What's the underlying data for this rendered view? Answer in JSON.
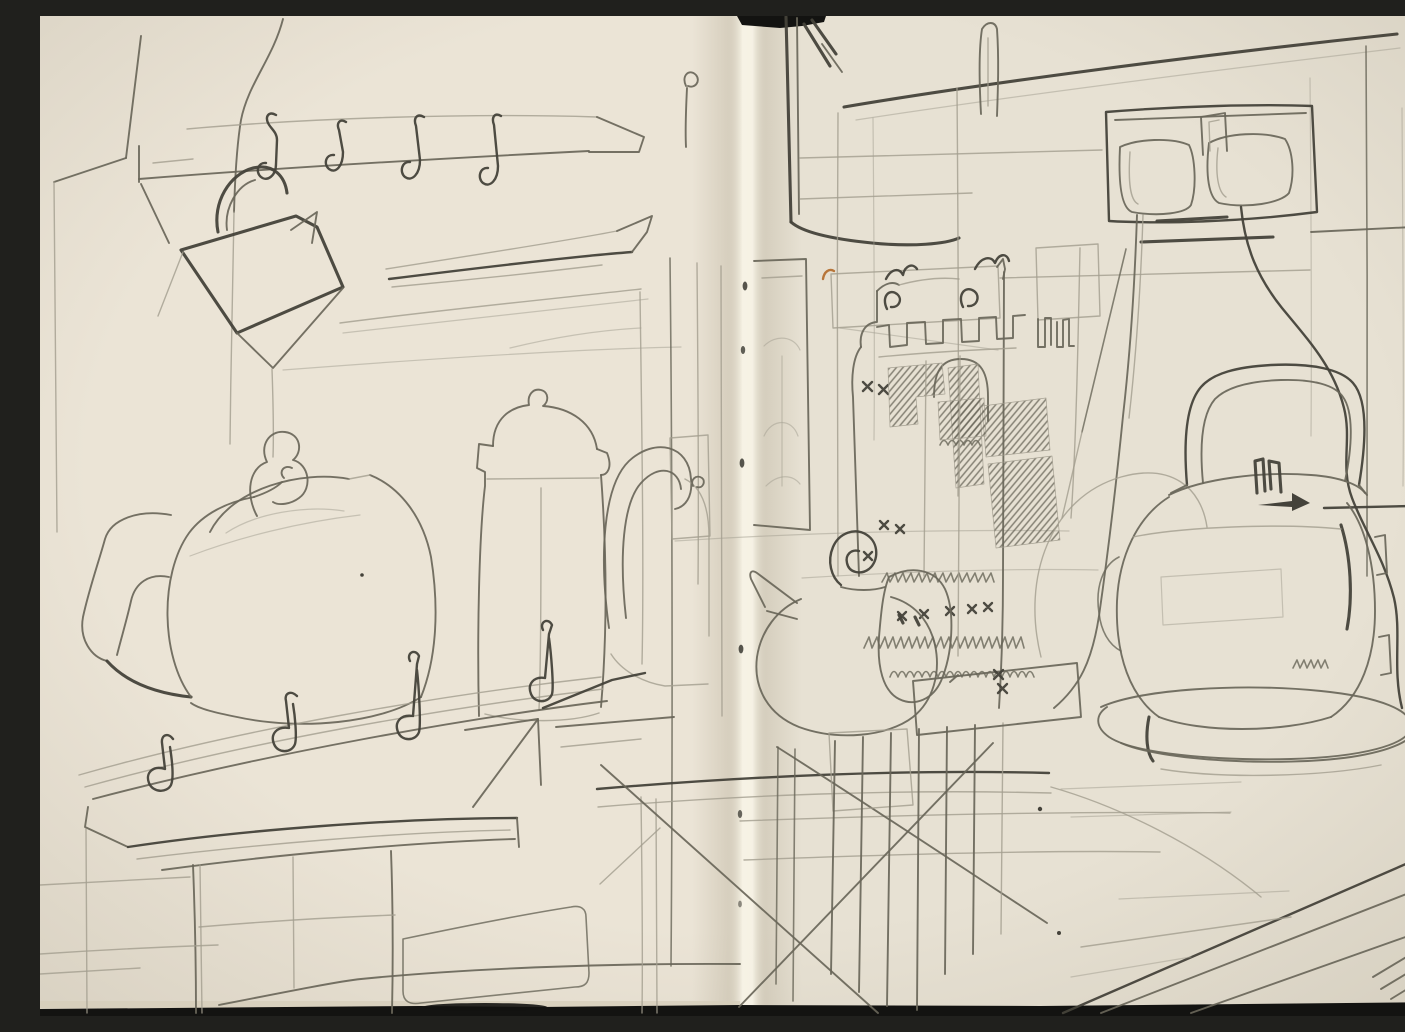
{
  "artwork": {
    "kind": "graphite pencil sketch across a stitched sketchbook double-page spread",
    "subject": "kitchen counter still life",
    "aria_label": "Pencil sketch of a kitchen: on the left page a hook rail with S-hooks and a hanging kettle above a large teapot, tall coffee pot and loop-handled jug on a counter; on the right page a castellated knitted cosy tower, a spiral-lid teapot, a double wall socket with two plugs and trailing cords, and an electric kettle with a squared handle standing on an oval tray",
    "left_page_items": [
      "upper hook rail with four S-hooks",
      "kettle hanging from the rail",
      "tapered shelf plank",
      "large teapot with curved spout and knobbed lid",
      "tall coffee pot with domed lid",
      "jug with large loop handle",
      "lower hook rail with four S-hooks",
      "counter edge with legs",
      "rounded tray panel on counter front"
    ],
    "right_page_items": [
      "wall corner and ceiling lines",
      "stove pipe",
      "castellated cosy tower with knitted hatch pattern",
      "teapot with spiral lid knob",
      "small covered jug with stitch marks",
      "double wall socket with two plugs and trailing cords",
      "electric kettle with squared handle on oval tray",
      "crossed counter diagonals and hatched legs"
    ],
    "book_features": [
      "stitched centre gutter with thread holes",
      "black scan edge at top notch, bottom and right",
      "small orange fleck near the gutter"
    ]
  },
  "colors": {
    "paper": "#e9e3d4",
    "paper-left": "#ece6d7",
    "paper-right": "#e6e0d1",
    "gutter-light": "#f7f3e6",
    "gutter-shade": "#b7ae99",
    "pencil-light": "#a29d8f",
    "pencil-medium": "#696659",
    "pencil-dark": "#44423a",
    "scan-edge": "#131311",
    "page-edge-tan": "#d5cdba",
    "accent-fleck": "#b8763a"
  }
}
